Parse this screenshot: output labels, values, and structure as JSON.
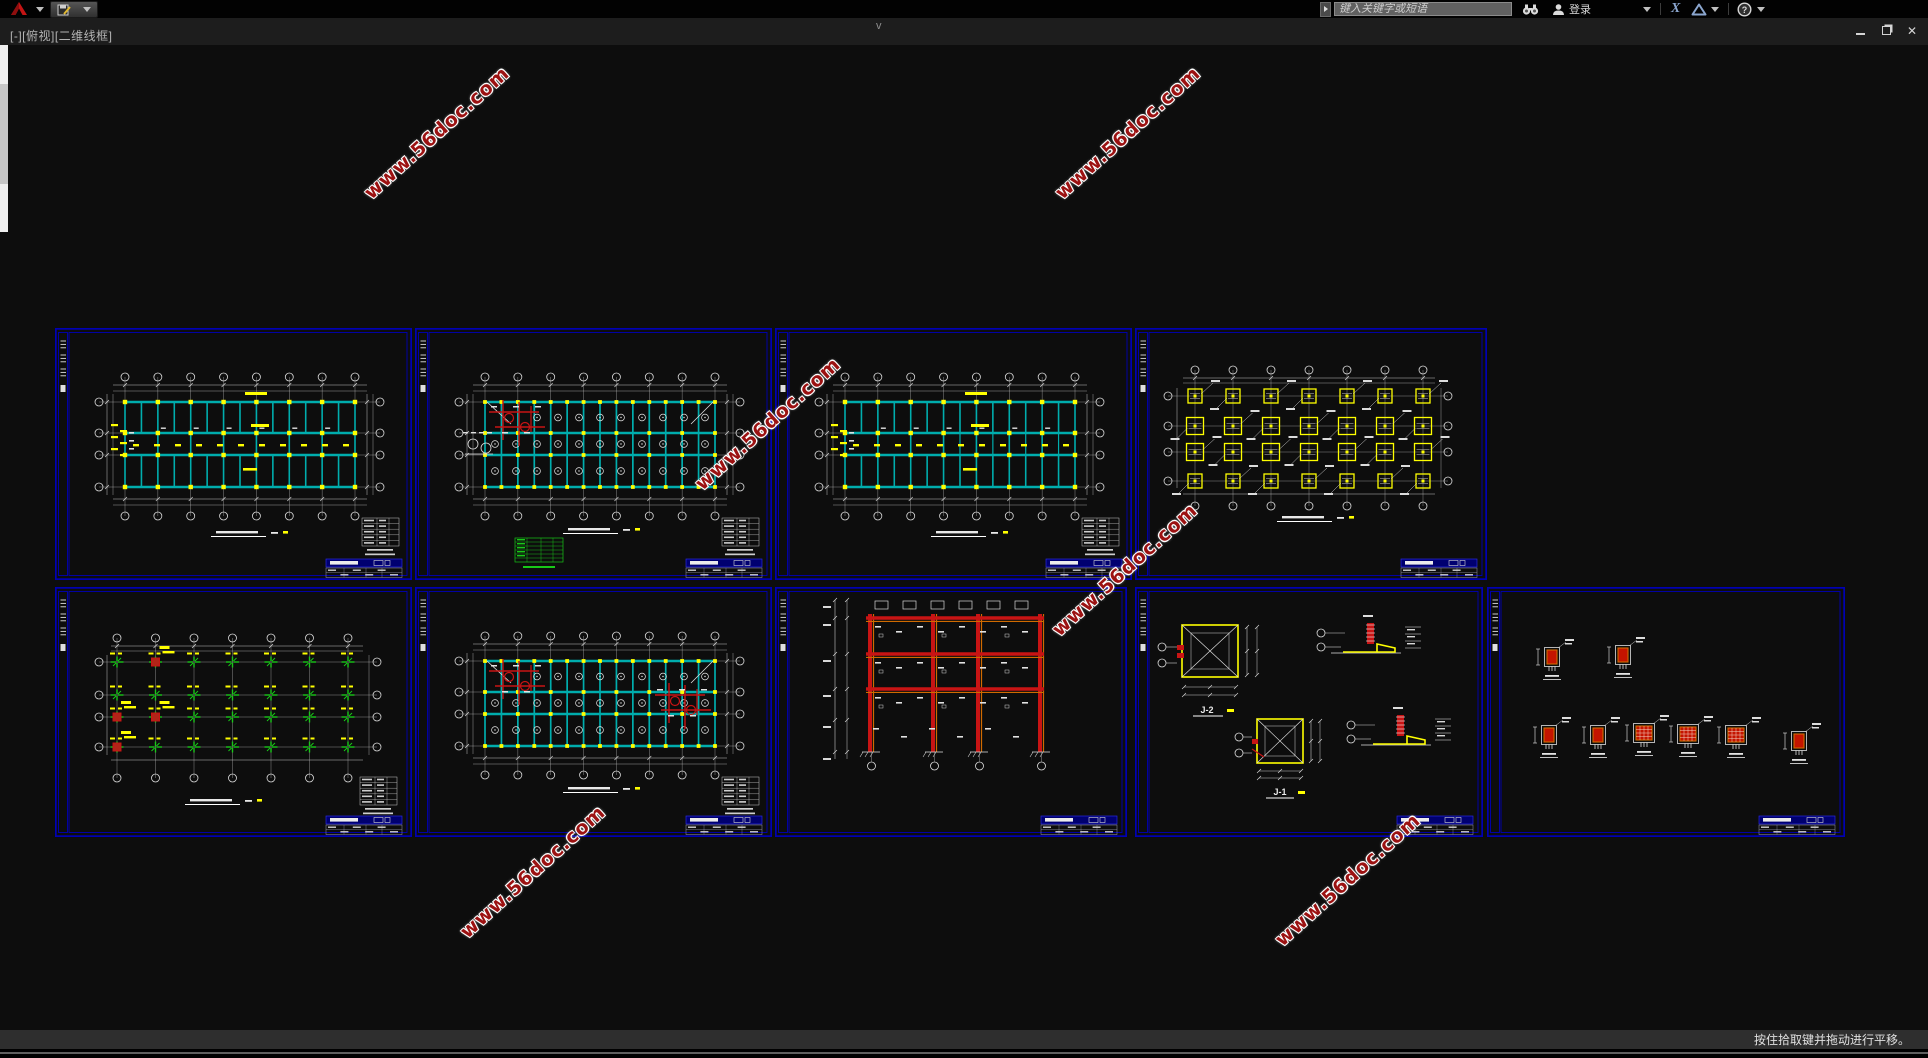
{
  "window": {
    "viewport_label": "[-][俯视][二维线框]",
    "top_center_glyph": "v",
    "controls": {
      "minimize": "最小化",
      "restore": "还原",
      "close": "关闭"
    }
  },
  "infocenter": {
    "search_placeholder": "键入关键字或短语",
    "signin_label": "登录"
  },
  "notes_panel": {
    "title": "结构设计总说明",
    "row_numbers": [
      "1",
      "2",
      "3",
      "4",
      "5",
      "6",
      "7",
      "8",
      "9",
      "10"
    ]
  },
  "watermark": {
    "text": "www.56doc.com"
  },
  "statusbar": {
    "hint": "按住拾取键并拖动进行平移。"
  },
  "details": {
    "j1": "J-1",
    "j2": "J-2"
  },
  "colors": {
    "sheet_border": "#0000b4",
    "beam_teal": "#00adad",
    "column_yellow": "#ffff00",
    "detail_red": "#c81414",
    "detail_orange": "#d06a00",
    "symbol_green": "#18c818",
    "grid_gray": "#9a9a9a",
    "text_white": "#e4e4e4",
    "notes_cyan": "#00c8c8",
    "watermark_red": "#9c1212"
  },
  "panels": [
    {
      "name": "panel-beam-reinforcement-plan-1"
    },
    {
      "name": "panel-slab-reinforcement-plan-1"
    },
    {
      "name": "panel-beam-reinforcement-plan-2"
    },
    {
      "name": "panel-foundation-layout-plan"
    },
    {
      "name": "panel-column-layout-plan"
    },
    {
      "name": "panel-slab-reinforcement-plan-2"
    },
    {
      "name": "panel-frame-elevation"
    },
    {
      "name": "panel-foundation-details"
    },
    {
      "name": "panel-column-section-details"
    }
  ]
}
